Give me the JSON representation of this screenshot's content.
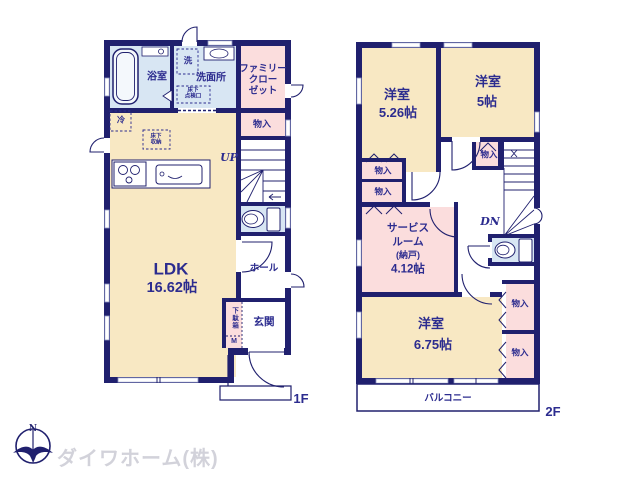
{
  "page": {
    "background": "#ffffff"
  },
  "colors": {
    "wall_navy": "#20206e",
    "text_navy": "#2c2c8f",
    "room_cream": "#f8e8c3",
    "closet_pink": "#fbdddd",
    "wet_area_blue": "#d8e6f3",
    "logo_gray": "#d2d2da"
  },
  "floor1": {
    "label": "1F",
    "ldk": {
      "name": "LDK",
      "size": "16.62帖"
    },
    "bath": "浴室",
    "washer": "洗",
    "washroom": "洗面所",
    "underfloor_access": [
      "床下",
      "点検口"
    ],
    "family_closet": [
      "ファミリー",
      "クロー",
      "ゼット"
    ],
    "fridge": "冷",
    "underfloor_storage": [
      "床下",
      "収納"
    ],
    "storage": "物入",
    "stairs": "UP",
    "hall": "ホール",
    "entrance": "玄関",
    "shoe_box": "下駄箱",
    "shoe_box_size": "M"
  },
  "floor2": {
    "label": "2F",
    "room_a": {
      "name": "洋室",
      "size": "5.26帖"
    },
    "room_b": {
      "name": "洋室",
      "size": "5帖"
    },
    "room_c": {
      "name": "洋室",
      "size": "6.75帖"
    },
    "service_room": [
      "サービス",
      "ルーム",
      "(納戸)",
      "4.12帖"
    ],
    "storage": "物入",
    "stairs": "DN",
    "balcony": "バルコニー"
  },
  "logo": {
    "compass_north": "N",
    "company": "ダイワホーム(株)"
  }
}
